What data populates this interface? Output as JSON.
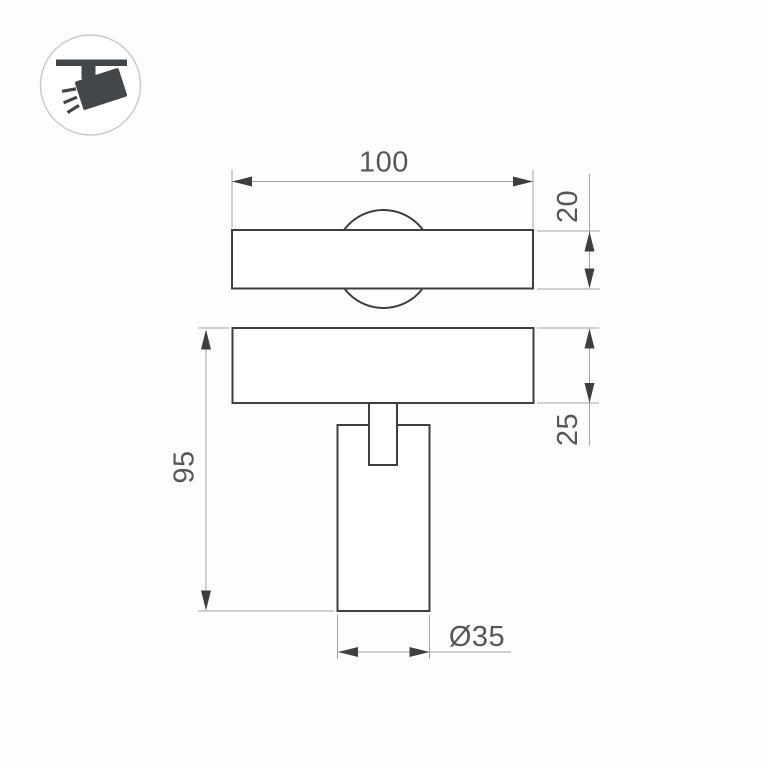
{
  "page": {
    "background": "#ffffff"
  },
  "icon": {
    "name": "track-spotlight-pictogram",
    "circle_stroke": "#c8cacc",
    "glyph_color": "#43474b"
  },
  "drawing": {
    "colors": {
      "object_line": "#3c3f42",
      "dimension_line": "#9fa1a4",
      "text": "#55585b"
    },
    "dimensions": {
      "width": {
        "label": "100"
      },
      "track_thickness": {
        "label": "20"
      },
      "base_height": {
        "label": "25"
      },
      "total_height": {
        "label": "95"
      },
      "diameter": {
        "label": "Ø35"
      }
    }
  }
}
